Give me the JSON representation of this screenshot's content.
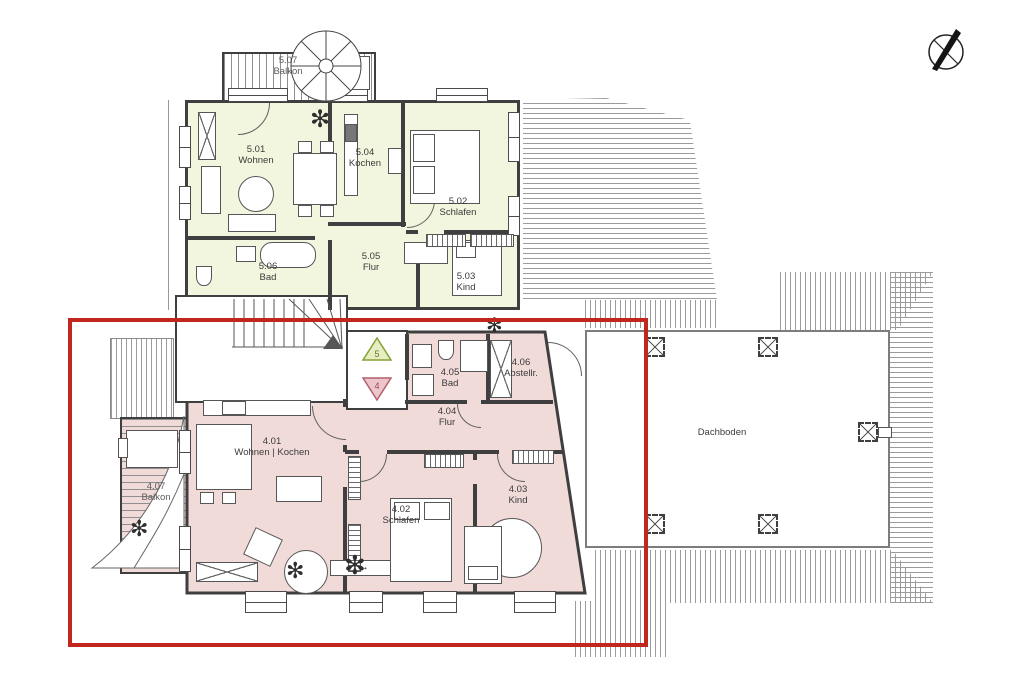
{
  "plan": {
    "attic": {
      "name": "Dachboden"
    },
    "stair_markers": {
      "up_level": "5",
      "down_level": "4"
    },
    "rooms": {
      "w501": {
        "num": "5.01",
        "name": "Wohnen"
      },
      "k504": {
        "num": "5.04",
        "name": "Kochen"
      },
      "s502": {
        "num": "5.02",
        "name": "Schlafen"
      },
      "b506": {
        "num": "5.06",
        "name": "Bad"
      },
      "f505": {
        "num": "5.05",
        "name": "Flur"
      },
      "k503": {
        "num": "5.03",
        "name": "Kind"
      },
      "b507": {
        "num": "5.07",
        "name": "Balkon"
      },
      "wk401": {
        "num": "4.01",
        "name": "Wohnen | Kochen"
      },
      "s402": {
        "num": "4.02",
        "name": "Schlafen"
      },
      "k403": {
        "num": "4.03",
        "name": "Kind"
      },
      "f404": {
        "num": "4.04",
        "name": "Flur"
      },
      "b405": {
        "num": "4.05",
        "name": "Bad"
      },
      "a406": {
        "num": "4.06",
        "name": "Abstellr."
      },
      "b407": {
        "num": "4.07",
        "name": "Balkon"
      }
    },
    "icons": {
      "compass": "north-compass-icon",
      "parasol": "parasol-icon",
      "plant_glyph": "✻",
      "tv_arrow_glyph": "↔"
    },
    "colors": {
      "upper_apartment_fill": "#f3f6de",
      "lower_apartment_fill": "#f0dbd9",
      "highlight_outline": "#c1271d"
    }
  }
}
